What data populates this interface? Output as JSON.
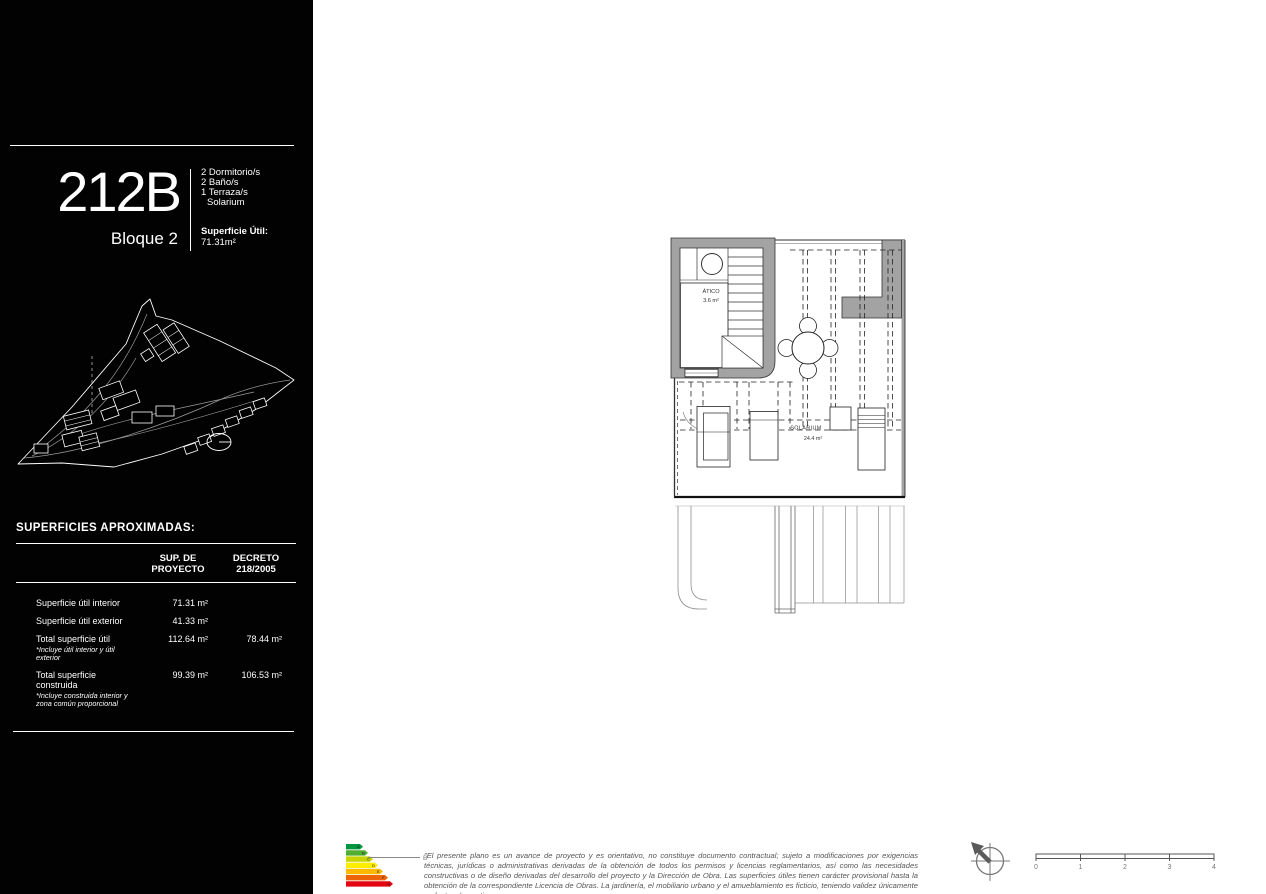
{
  "sidebar": {
    "unit": {
      "id": "212B",
      "block": "Bloque 2",
      "features": [
        "2 Dormitorio/s",
        "2 Baño/s",
        "1 Terraza/s",
        "Solarium"
      ],
      "area_label": "Superficie Útil:",
      "area_value": "71.31m²"
    },
    "areas_table": {
      "title": "SUPERFICIES APROXIMADAS:",
      "columns": [
        {
          "l1": "SUP. DE",
          "l2": "PROYECTO"
        },
        {
          "l1": "DECRETO",
          "l2": "218/2005"
        }
      ],
      "rows": [
        {
          "label": "Superficie útil interior",
          "note": "",
          "proyecto": "71.31 m²",
          "decreto": ""
        },
        {
          "label": "Superficie útil exterior",
          "note": "",
          "proyecto": "41.33 m²",
          "decreto": ""
        },
        {
          "label": "Total superficie útil",
          "note": "*Incluye útil interior y útil exterior",
          "proyecto": "112.64 m²",
          "decreto": "78.44 m²"
        },
        {
          "label": "Total superficie construida",
          "note": "*Incluye construida interior y zona común proporcional",
          "proyecto": "99.39 m²",
          "decreto": "106.53 m²"
        }
      ]
    }
  },
  "plan": {
    "atico": {
      "label": "ÁTICO",
      "area": "3.6 m²"
    },
    "solarium": {
      "label": "SOLARIUM",
      "area": "24.4 m²"
    }
  },
  "footer": {
    "energy": {
      "rating": "B",
      "scale": [
        "A",
        "B",
        "C",
        "D",
        "E",
        "F",
        "G"
      ],
      "colors": [
        "#009640",
        "#52ae32",
        "#c8d400",
        "#ffed00",
        "#fbba00",
        "#ec6608",
        "#e30613"
      ]
    },
    "disclaimer": "\"El presente plano es un avance de proyecto y es orientativo, no constituye documento contractual; sujeto a modificaciones por exigencias técnicas, jurídicas o administrativas derivadas de la obtención de todos los permisos y licencias  reglamentarios, así como las necesidades constructivas o de diseño derivadas del desarrollo del proyecto y la Dirección de Obra. Las superficies útiles tienen carácter provisional hasta la obtención de la correspondiente Licencia de Obras. La jardinería, el mobiliario urbano y el amueblamiento es ficticio, teniendo validez únicamente a efectos decorativos",
    "scale_bar": {
      "ticks": [
        "0",
        "1",
        "2",
        "3",
        "4"
      ]
    }
  },
  "colors": {
    "sidebar_bg": "#020202",
    "wall_gray": "#a3a3a3",
    "plan_line": "#222222",
    "muted_text": "#555555"
  }
}
